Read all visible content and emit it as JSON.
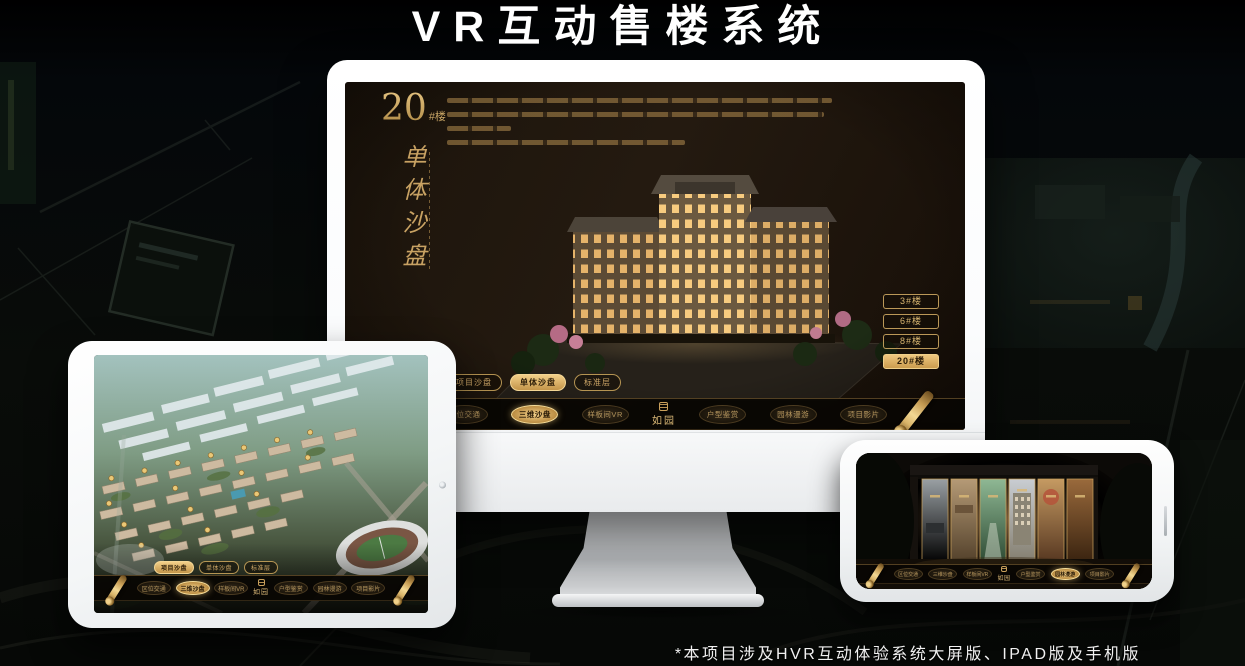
{
  "page": {
    "title": "VR互动售楼系统",
    "footnote": "*本项目涉及HVR互动体验系统大屏版、IPAD版及手机版"
  },
  "colors": {
    "gold": "#c9a063",
    "gold_bright": "#ecc67e",
    "nav_background": "#0c0906",
    "screen_background": "#1c140b",
    "active_text": "#241604",
    "title_text": "#ffffff"
  },
  "icons": {
    "scroll": "scroll-icon",
    "seal": "seal-icon",
    "camera": "camera-icon",
    "side_button": "side-button"
  },
  "monitor_app": {
    "headline": {
      "number": "20",
      "unit": "#楼",
      "subtitle": "单体沙盘"
    },
    "floor_buttons": [
      {
        "label": "3#楼",
        "active": false
      },
      {
        "label": "6#楼",
        "active": false
      },
      {
        "label": "8#楼",
        "active": false
      },
      {
        "label": "20#楼",
        "active": true
      }
    ],
    "mode_pills": [
      {
        "label": "项目沙盘",
        "active": false
      },
      {
        "label": "单体沙盘",
        "active": true
      },
      {
        "label": "标准层",
        "active": false
      }
    ],
    "nav": {
      "logo": "如园",
      "items": [
        {
          "label": "区位交通",
          "active": false
        },
        {
          "label": "三维沙盘",
          "active": true
        },
        {
          "label": "样板间VR",
          "active": false
        },
        {
          "label": "户型鉴赏",
          "active": false
        },
        {
          "label": "园林漫游",
          "active": false
        },
        {
          "label": "项目影片",
          "active": false
        }
      ]
    }
  },
  "tablet_app": {
    "mode_pills": [
      {
        "label": "项目沙盘",
        "active": true
      },
      {
        "label": "单体沙盘",
        "active": false
      },
      {
        "label": "标准层",
        "active": false
      }
    ],
    "nav": {
      "logo": "如园",
      "items": [
        {
          "label": "区位交通",
          "active": false
        },
        {
          "label": "三维沙盘",
          "active": true
        },
        {
          "label": "样板间VR",
          "active": false
        },
        {
          "label": "户型鉴赏",
          "active": false
        },
        {
          "label": "园林漫游",
          "active": false
        },
        {
          "label": "项目影片",
          "active": false
        }
      ]
    }
  },
  "phone_app": {
    "nav": {
      "logo": "如园",
      "items": [
        {
          "label": "区位交通",
          "active": false
        },
        {
          "label": "三维沙盘",
          "active": false
        },
        {
          "label": "样板间VR",
          "active": false
        },
        {
          "label": "户型鉴赏",
          "active": false
        },
        {
          "label": "园林漫游",
          "active": true
        },
        {
          "label": "项目影片",
          "active": false
        }
      ]
    }
  }
}
